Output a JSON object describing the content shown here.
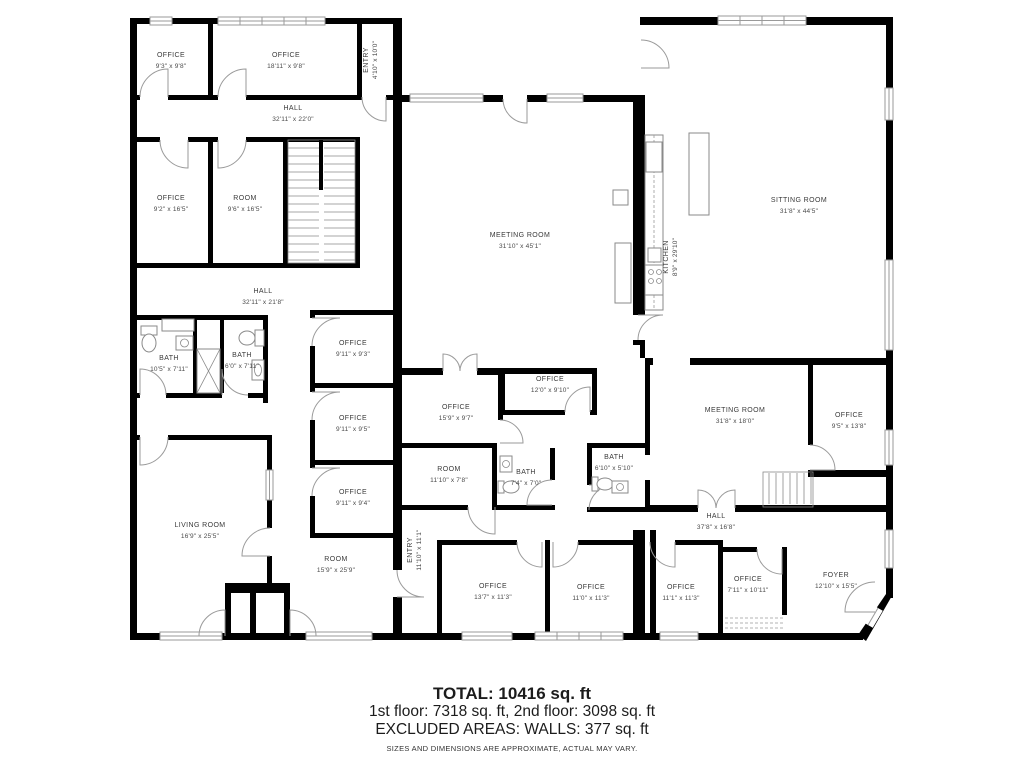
{
  "colors": {
    "wall": "#000000",
    "window": "#9a9a9a",
    "door_arc": "#9a9a9a",
    "label_text": "#3a3a3a",
    "background": "#ffffff"
  },
  "footer": {
    "total": "TOTAL: 10416 sq. ft",
    "floors": "1st floor: 7318 sq. ft, 2nd floor: 3098 sq. ft",
    "excluded": "EXCLUDED AREAS: WALLS: 377 sq. ft",
    "disclaimer": "SIZES AND DIMENSIONS ARE APPROXIMATE, ACTUAL MAY VARY."
  },
  "rooms": [
    {
      "id": "office-a",
      "name": "OFFICE",
      "dims": "9'3\" x 9'8\""
    },
    {
      "id": "office-b",
      "name": "OFFICE",
      "dims": "18'11\" x 9'8\""
    },
    {
      "id": "entry-top",
      "name": "ENTRY",
      "dims": "4'10\" x 10'0\""
    },
    {
      "id": "hall-top",
      "name": "HALL",
      "dims": "32'11\" x 22'0\""
    },
    {
      "id": "office-c",
      "name": "OFFICE",
      "dims": "9'2\" x 16'5\""
    },
    {
      "id": "room-a",
      "name": "ROOM",
      "dims": "9'6\" x 16'5\""
    },
    {
      "id": "hall-mid",
      "name": "HALL",
      "dims": "32'11\" x 21'8\""
    },
    {
      "id": "bath-a",
      "name": "BATH",
      "dims": "10'5\" x 7'11\""
    },
    {
      "id": "bath-b",
      "name": "BATH",
      "dims": "6'0\" x 7'11\""
    },
    {
      "id": "office-d",
      "name": "OFFICE",
      "dims": "9'11\" x 9'3\""
    },
    {
      "id": "office-e",
      "name": "OFFICE",
      "dims": "9'11\" x 9'5\""
    },
    {
      "id": "office-f",
      "name": "OFFICE",
      "dims": "9'11\" x 9'4\""
    },
    {
      "id": "living-room",
      "name": "LIVING ROOM",
      "dims": "16'9\" x 25'5\""
    },
    {
      "id": "room-b",
      "name": "ROOM",
      "dims": "15'9\" x 25'9\""
    },
    {
      "id": "meeting-room-a",
      "name": "MEETING ROOM",
      "dims": "31'10\" x 45'1\""
    },
    {
      "id": "kitchen",
      "name": "KITCHEN",
      "dims": "8'9\" x 29'10\""
    },
    {
      "id": "office-g",
      "name": "OFFICE",
      "dims": "12'0\" x 9'10\""
    },
    {
      "id": "office-h",
      "name": "OFFICE",
      "dims": "15'9\" x 9'7\""
    },
    {
      "id": "room-c",
      "name": "ROOM",
      "dims": "11'10\" x 7'8\""
    },
    {
      "id": "bath-c",
      "name": "BATH",
      "dims": "7'4\" x 7'0\""
    },
    {
      "id": "bath-d",
      "name": "BATH",
      "dims": "6'10\" x 5'10\""
    },
    {
      "id": "entry-bottom",
      "name": "ENTRY",
      "dims": "11'10\" x 11'1\""
    },
    {
      "id": "office-i",
      "name": "OFFICE",
      "dims": "13'7\" x 11'3\""
    },
    {
      "id": "office-j",
      "name": "OFFICE",
      "dims": "11'0\" x 11'3\""
    },
    {
      "id": "sitting-room",
      "name": "SITTING ROOM",
      "dims": "31'8\" x 44'5\""
    },
    {
      "id": "meeting-room-b",
      "name": "MEETING ROOM",
      "dims": "31'8\" x 18'0\""
    },
    {
      "id": "office-k",
      "name": "OFFICE",
      "dims": "9'5\" x 13'8\""
    },
    {
      "id": "hall-right",
      "name": "HALL",
      "dims": "37'8\" x 16'8\""
    },
    {
      "id": "office-l",
      "name": "OFFICE",
      "dims": "11'1\" x 11'3\""
    },
    {
      "id": "office-m",
      "name": "OFFICE",
      "dims": "7'11\" x 10'11\""
    },
    {
      "id": "foyer",
      "name": "FOYER",
      "dims": "12'10\" x 15'5\""
    }
  ]
}
